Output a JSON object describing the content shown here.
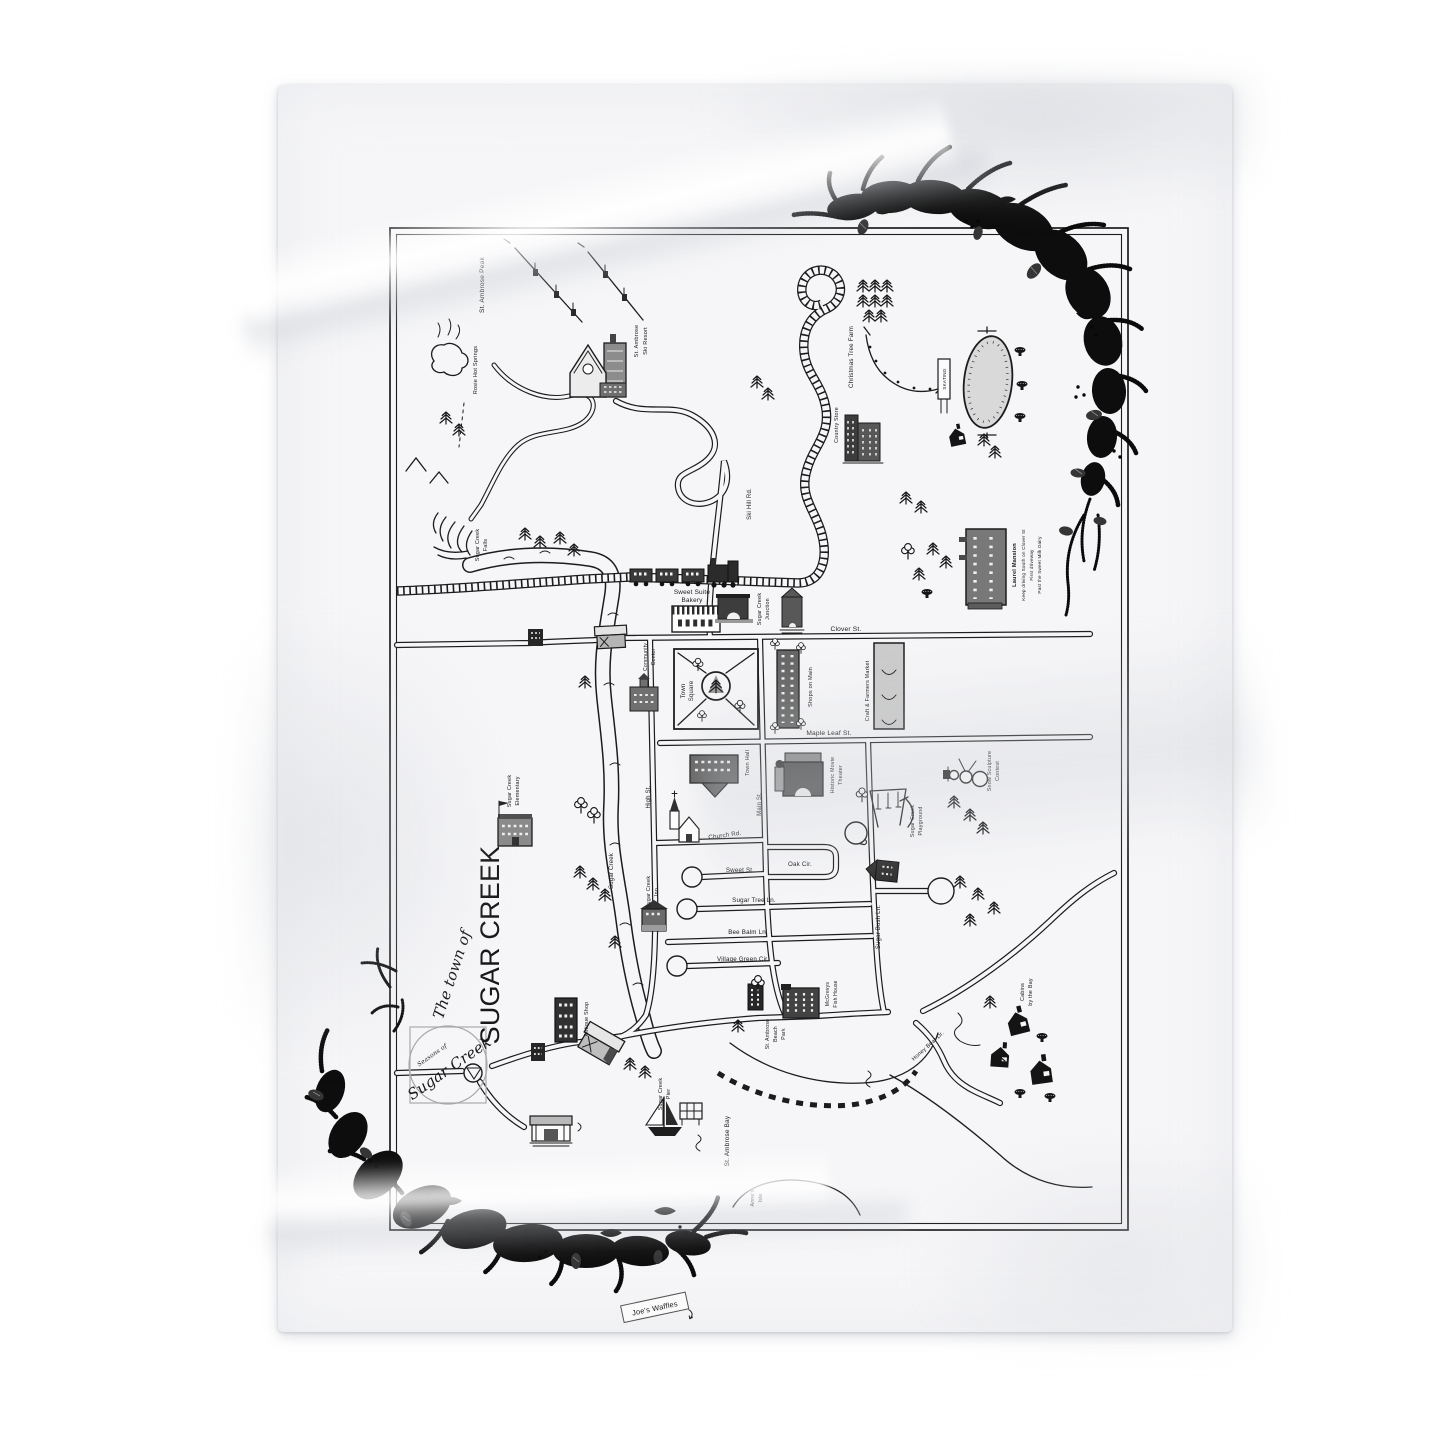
{
  "page": {
    "background": "#ffffff"
  },
  "blanket": {
    "color": "#f6f6f8",
    "tag": {
      "label": "Joe's Waffles"
    }
  },
  "palette": {
    "ink": "#1c1c1c",
    "garland": "#0d0d0d",
    "rink_gray": "#d9d9d9",
    "market_gray": "#cbcbcb"
  },
  "map": {
    "title": {
      "script": "The town of",
      "main": "SUGAR CREEK"
    },
    "logo": {
      "small": "Seasons of",
      "script": "Sugar Creek"
    },
    "labels": {
      "st_ambrose_peak": "St. Ambrose Peak",
      "rosie_hot_springs": "Rosie Hot Springs",
      "ski_resort_1": "St. Ambrose",
      "ski_resort_2": "Ski Resort",
      "falls_1": "Sugar Creek",
      "falls_2": "Falls",
      "ski_hill_rd": "Ski Hill Rd.",
      "christmas_tree_farm": "Christmas Tree Farm",
      "country_store": "Country Store",
      "skating": "SKATING",
      "laurel_1": "Laurel Mansion",
      "laurel_2": "Keep driving South on Clover St",
      "laurel_3": "First driveway",
      "laurel_4": "Past the Sweet Milk Dairy",
      "sweet_suite_1": "Sweet Suite",
      "sweet_suite_2": "Bakery",
      "junction_1": "Sugar Creek",
      "junction_2": "Junction",
      "clover_st": "Clover St.",
      "community_center_1": "Community",
      "community_center_2": "Center",
      "town_square_1": "Town",
      "town_square_2": "Square",
      "shops_on_main": "Shops on Main",
      "craft_farmers_market": "Craft & Farmers Market",
      "maple_leaf_st": "Maple Leaf St.",
      "town_hall": "Town Hall",
      "movie_theater_1": "Historic Movie",
      "movie_theater_2": "Theater",
      "main_st": "Main St.",
      "high_st": "High St.",
      "church_rd": "Church Rd.",
      "sweet_st": "Sweet St.",
      "oak_cir": "Oak Cir.",
      "sugar_tree_ln": "Sugar Tree Ln.",
      "bee_balm_ln": "Bee Balm Ln.",
      "village_green_cir": "Village Green Cir.",
      "sugar_bush_ln": "Sugar Bush Ln.",
      "playground_1": "Sugar Creek",
      "playground_2": "Playground",
      "snow_1": "Snow Sculpture",
      "snow_2": "Contest",
      "elementary_1": "Sugar Creek",
      "elementary_2": "Elementary",
      "creek": "Sugar Creek",
      "inn_1": "Sugar Creek",
      "inn_2": "Inn",
      "antique_shop": "Antique Shop",
      "pier_1": "Sugar Creek",
      "pier_2": "Pier",
      "beach_park_1": "St. Ambrose",
      "beach_park_2": "Beach",
      "beach_park_3": "Park",
      "mcgrevys_1": "McGrevys",
      "mcgrevys_2": "Fish House",
      "honey_bear_dr": "Honey Bear Dr.",
      "cabins_1": "Cabins",
      "cabins_2": "by the Bay",
      "st_ambrose_bay": "St. Ambrose Bay",
      "annes_isle_1": "Anne's",
      "annes_isle_2": "Isle"
    }
  }
}
